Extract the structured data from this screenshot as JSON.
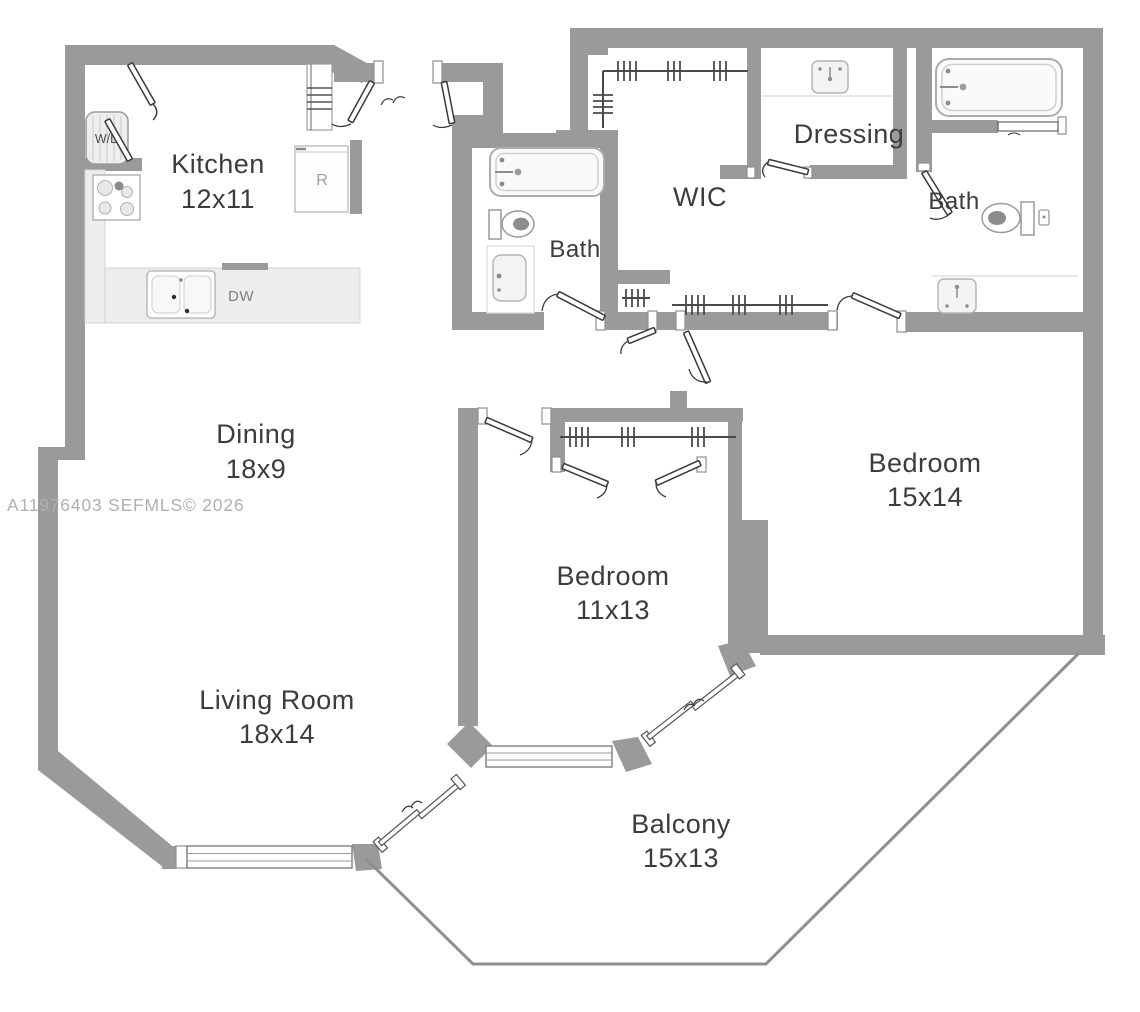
{
  "meta": {
    "watermark": "A11976403  SEFMLS© 2026"
  },
  "rooms": {
    "kitchen": {
      "name": "Kitchen",
      "dims": "12x11"
    },
    "dining": {
      "name": "Dining",
      "dims": "18x9"
    },
    "living": {
      "name": "Living Room",
      "dims": "18x14"
    },
    "bedroom1": {
      "name": "Bedroom",
      "dims": "11x13"
    },
    "bedroom2": {
      "name": "Bedroom",
      "dims": "15x14"
    },
    "balcony": {
      "name": "Balcony",
      "dims": "15x13"
    },
    "bath1": {
      "name": "Bath"
    },
    "bath2": {
      "name": "Bath"
    },
    "wic": {
      "name": "WIC"
    },
    "dressing": {
      "name": "Dressing"
    }
  },
  "appliances": {
    "washer_dryer": "W/D",
    "refrigerator": "R",
    "dishwasher": "DW"
  },
  "colors": {
    "wall": "#9a9a9a",
    "label": "#3c3c3c",
    "watermark": "#b0b0b0",
    "fixture_stroke": "#b0b0b0",
    "counter_fill": "#ededed"
  }
}
